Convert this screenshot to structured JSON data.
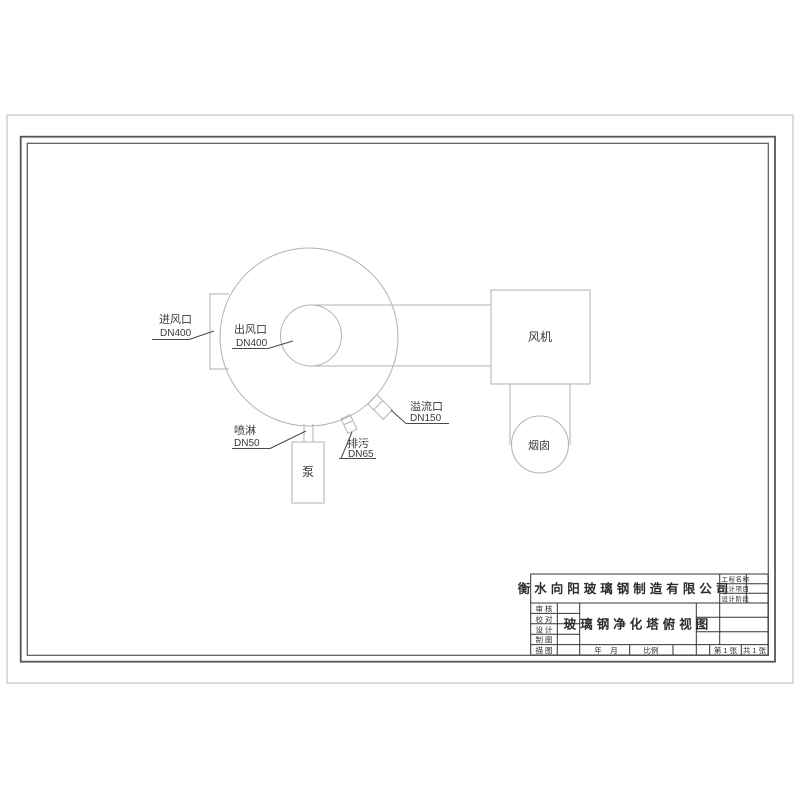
{
  "colors": {
    "equipment_line": "#b2b2b2",
    "leader_line": "#4a4a4a",
    "frame_border": "#555555",
    "title_block_line": "#333333",
    "text": "#3a3a3a",
    "paper": "#ffffff"
  },
  "drawing": {
    "labels": {
      "inlet_name": "进风口",
      "inlet_dn": "DN400",
      "outlet_name": "出风口",
      "outlet_dn": "DN400",
      "overflow_name": "溢流口",
      "overflow_dn": "DN150",
      "drain_name": "排污",
      "drain_dn": "DN65",
      "spray_name": "喷淋",
      "spray_dn": "DN50",
      "fan": "风机",
      "chimney": "烟囱",
      "pump": "泵"
    }
  },
  "title_block": {
    "company": "衡水向阳玻璃钢制造有限公司",
    "drawing_title": "玻璃钢净化塔俯视图",
    "project_fields": [
      "工程名称",
      "设计项目",
      "设计阶段"
    ],
    "role_fields": [
      "审核",
      "校对",
      "设计",
      "制图",
      "描图"
    ],
    "year_label": "年",
    "month_label": "月",
    "scale_label": "比例",
    "sheet_number": "第 1 张",
    "sheet_total": "共 1 张"
  }
}
